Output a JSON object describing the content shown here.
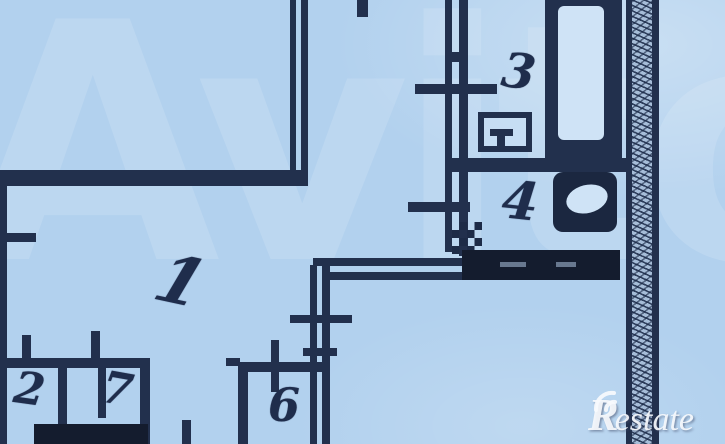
{
  "plan": {
    "room_labels": {
      "r1": "1",
      "r2": "2",
      "r3": "3",
      "r4": "4",
      "r6": "6",
      "r7": "7"
    },
    "fixtures": [
      "bathtub-icon",
      "sink-icon",
      "toilet-icon"
    ],
    "colors": {
      "background": "#b2d1ee",
      "wall": "#22304d",
      "dark_fill": "#141c2e",
      "hatch_fill": "#a6bdd8",
      "watermark_white": "rgba(255,255,255,0.13)"
    },
    "watermarks": {
      "avito": "Avito",
      "restate_initial": "R",
      "restate_rest": "estate"
    }
  }
}
